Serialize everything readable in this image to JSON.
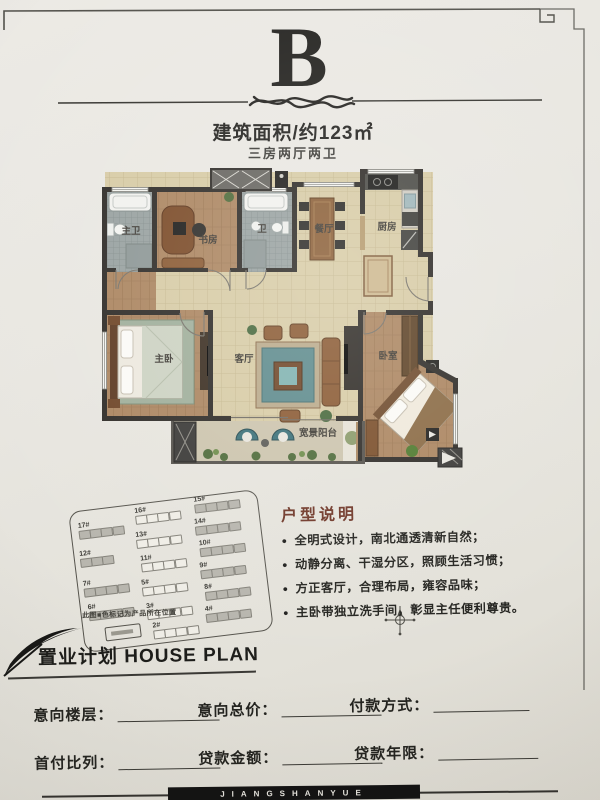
{
  "header": {
    "plan_letter": "B",
    "area_text": "建筑面积/约123㎡",
    "layout_text": "三房两厅两卫"
  },
  "floorplan": {
    "rooms": [
      {
        "id": "master-bath",
        "label": "主卫"
      },
      {
        "id": "study",
        "label": "书房"
      },
      {
        "id": "bath",
        "label": "卫"
      },
      {
        "id": "dining",
        "label": "餐厅"
      },
      {
        "id": "kitchen",
        "label": "厨房"
      },
      {
        "id": "master-bedroom",
        "label": "主卧"
      },
      {
        "id": "living-room",
        "label": "客厅"
      },
      {
        "id": "bedroom",
        "label": "卧室"
      },
      {
        "id": "balcony",
        "label": "宽景阳台"
      }
    ]
  },
  "siteplan": {
    "caption": "此图■色标记为产品所在位置",
    "buildings": [
      {
        "label": "17#"
      },
      {
        "label": "12#"
      },
      {
        "label": "7#"
      },
      {
        "label": "6#"
      },
      {
        "label": "16#"
      },
      {
        "label": "13#"
      },
      {
        "label": "11#"
      },
      {
        "label": "5#"
      },
      {
        "label": "3#"
      },
      {
        "label": "2#"
      },
      {
        "label": "15#"
      },
      {
        "label": "14#"
      },
      {
        "label": "10#"
      },
      {
        "label": "9#"
      },
      {
        "label": "8#"
      },
      {
        "label": "4#"
      }
    ]
  },
  "description": {
    "title": "户型说明",
    "bullets": [
      "全明式设计，南北通透清新自然；",
      "动静分离、干湿分区，照顾生活习惯；",
      "方正客厅，合理布局，雍容品味；",
      "主卧带独立洗手间，彰显主任便利尊贵。"
    ]
  },
  "house_plan": {
    "title": "置业计划 HOUSE PLAN",
    "fields": [
      {
        "label": "意向楼层："
      },
      {
        "label": "意向总价："
      },
      {
        "label": "付款方式："
      },
      {
        "label": "首付比列："
      },
      {
        "label": "贷款金额："
      },
      {
        "label": "贷款年限："
      }
    ]
  },
  "footer": {
    "brand": "JIANGSHANYUE"
  },
  "colors": {
    "paper": "#e8e6e0",
    "ink": "#23221f",
    "desc_title": "#6e3526",
    "wall": "#2e2b27",
    "wood_floor": "#ab8560",
    "tile_floor": "#d7cba5",
    "bath_floor": "#98a1a1",
    "accent_teal": "#3f7d85"
  }
}
